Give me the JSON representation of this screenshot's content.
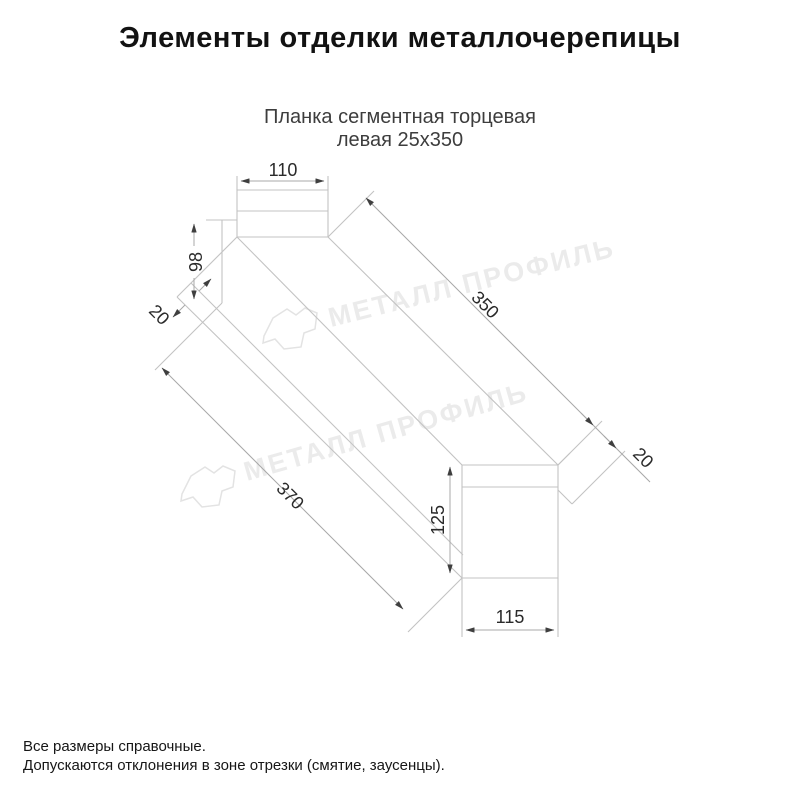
{
  "header": {
    "title": "Элементы отделки металлочерепицы"
  },
  "subtitle": {
    "line1": "Планка сегментная торцевая",
    "line2": "левая 25х350"
  },
  "watermark": {
    "brand": "МЕТАЛЛ ПРОФИЛЬ"
  },
  "dims": {
    "top_flange_width": "110",
    "face_width": "98",
    "left_hem": "20",
    "top_edge_length": "350",
    "right_hem": "20",
    "bottom_edge_length": "370",
    "end_height": "125",
    "end_width": "115"
  },
  "footer": {
    "line1": "Все размеры справочные.",
    "line2": "Допускаются отклонения в зоне отрезки (смятие, заусенцы)."
  },
  "colors": {
    "part_line": "#c3c3c3",
    "dim_line": "#a8a8a8",
    "arrow": "#3f3f3f",
    "watermark": "#ebebeb",
    "title_text": "#121212",
    "subtitle_text": "#3d3d3d"
  }
}
